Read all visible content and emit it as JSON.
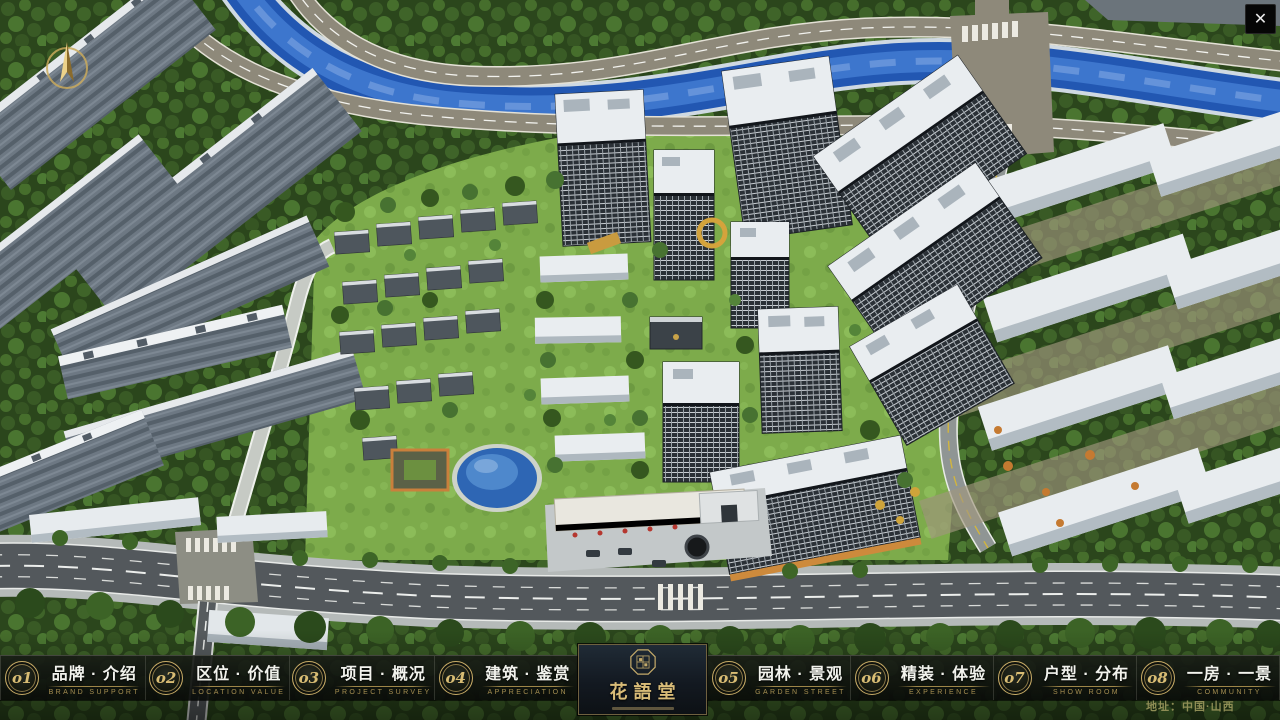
{
  "window": {
    "close_icon": "✕"
  },
  "nav": {
    "items": [
      {
        "num": "o1",
        "zh": "品牌 · 介绍",
        "en": "BRAND SUPPORT"
      },
      {
        "num": "o2",
        "zh": "区位 · 价值",
        "en": "LOCATION VALUE"
      },
      {
        "num": "o3",
        "zh": "项目 · 概况",
        "en": "PROJECT SURVEY"
      },
      {
        "num": "o4",
        "zh": "建筑 · 鉴赏",
        "en": "APPRECIATION"
      },
      {
        "num": "o5",
        "zh": "园林 · 景观",
        "en": "GARDEN STREET"
      },
      {
        "num": "o6",
        "zh": "精装 · 体验",
        "en": "EXPERIENCE"
      },
      {
        "num": "o7",
        "zh": "户型 · 分布",
        "en": "SHOW ROOM"
      },
      {
        "num": "o8",
        "zh": "一房 · 一景",
        "en": "COMMUNITY"
      }
    ],
    "logo": {
      "title": "花語堂"
    }
  },
  "footer": {
    "address": "地址：中国·山西"
  },
  "colors": {
    "gold": "#c7ab66",
    "gold_dim": "#a68f52",
    "bar_bg": "#0c0e0c",
    "text": "#f2f3ed"
  }
}
